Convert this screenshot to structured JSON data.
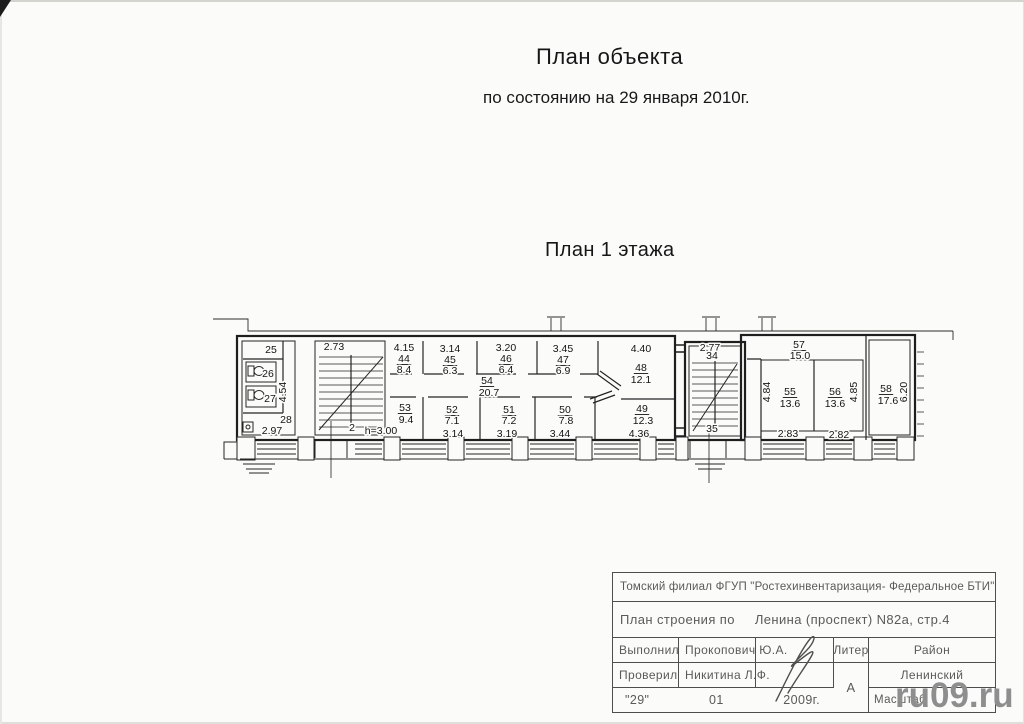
{
  "page": {
    "title": "План объекта",
    "subtitle": "по состоянию на 29 января 2010г.",
    "floor_label": "План 1 этажа",
    "watermark": "ru09.ru"
  },
  "title_block": {
    "org": "Томский филиал ФГУП \"Ростехинвентаризация- Федеральное БТИ\"",
    "doc_type_label": "План строения по",
    "address": "Ленина (проспект) N82а, стр.4",
    "made_label": "Выполнил",
    "made_by": "Прокопович Ю.А.",
    "checked_label": "Проверил",
    "checked_by": "Никитина Л.Ф.",
    "liter_label": "Литер",
    "liter_value": "А",
    "district_label": "Район",
    "district_value": "Ленинский",
    "date_day": "\"29\"",
    "date_month": "01",
    "date_year": "2009г.",
    "scale_label": "Масштаб"
  },
  "plan": {
    "labels": [
      {
        "t": "25",
        "x": 271,
        "y": 353
      },
      {
        "t": "26",
        "x": 268,
        "y": 377
      },
      {
        "t": "27",
        "x": 270,
        "y": 402
      },
      {
        "t": "28",
        "x": 286,
        "y": 423
      },
      {
        "t": "2.97",
        "x": 272,
        "y": 434
      },
      {
        "t": "4.54",
        "x": 286,
        "y": 392,
        "r": -90
      },
      {
        "t": "2.73",
        "x": 334,
        "y": 350
      },
      {
        "t": "2",
        "x": 352,
        "y": 431
      },
      {
        "t": "4.15",
        "x": 404,
        "y": 351
      },
      {
        "t": "44",
        "x": 404,
        "y": 362,
        "ul": 1
      },
      {
        "t": "8.4",
        "x": 404,
        "y": 373
      },
      {
        "t": "3.14",
        "x": 450,
        "y": 352
      },
      {
        "t": "45",
        "x": 450,
        "y": 363,
        "ul": 1
      },
      {
        "t": "6.3",
        "x": 450,
        "y": 374
      },
      {
        "t": "3.20",
        "x": 506,
        "y": 351
      },
      {
        "t": "46",
        "x": 506,
        "y": 362,
        "ul": 1
      },
      {
        "t": "6.4",
        "x": 506,
        "y": 373
      },
      {
        "t": "3.45",
        "x": 563,
        "y": 352
      },
      {
        "t": "47",
        "x": 563,
        "y": 363,
        "ul": 1
      },
      {
        "t": "6.9",
        "x": 563,
        "y": 374
      },
      {
        "t": "4.40",
        "x": 641,
        "y": 352
      },
      {
        "t": "48",
        "x": 641,
        "y": 371,
        "ul": 1
      },
      {
        "t": "12.1",
        "x": 641,
        "y": 383
      },
      {
        "t": "54",
        "x": 487,
        "y": 384,
        "ul": 1
      },
      {
        "t": "20.7",
        "x": 489,
        "y": 396
      },
      {
        "t": "53",
        "x": 405,
        "y": 411,
        "ul": 1
      },
      {
        "t": "9.4",
        "x": 406,
        "y": 423
      },
      {
        "t": "52",
        "x": 452,
        "y": 413,
        "ul": 1
      },
      {
        "t": "7.1",
        "x": 452,
        "y": 424
      },
      {
        "t": "3.14",
        "x": 453,
        "y": 437
      },
      {
        "t": "51",
        "x": 509,
        "y": 413,
        "ul": 1
      },
      {
        "t": "7.2",
        "x": 509,
        "y": 424
      },
      {
        "t": "3.19",
        "x": 507,
        "y": 437
      },
      {
        "t": "50",
        "x": 565,
        "y": 413,
        "ul": 1
      },
      {
        "t": "7.8",
        "x": 566,
        "y": 424
      },
      {
        "t": "3.44",
        "x": 560,
        "y": 437
      },
      {
        "t": "49",
        "x": 642,
        "y": 412,
        "ul": 1
      },
      {
        "t": "12.3",
        "x": 643,
        "y": 424
      },
      {
        "t": "4.36",
        "x": 639,
        "y": 437
      },
      {
        "t": "h=3.00",
        "x": 381,
        "y": 434
      },
      {
        "t": "2.77",
        "x": 710,
        "y": 351
      },
      {
        "t": "34",
        "x": 712,
        "y": 359
      },
      {
        "t": "35",
        "x": 712,
        "y": 432
      },
      {
        "t": "57",
        "x": 799,
        "y": 348,
        "ul": 1
      },
      {
        "t": "15.0",
        "x": 800,
        "y": 359
      },
      {
        "t": "55",
        "x": 790,
        "y": 395,
        "ul": 1
      },
      {
        "t": "13.6",
        "x": 790,
        "y": 407
      },
      {
        "t": "56",
        "x": 835,
        "y": 395,
        "ul": 1
      },
      {
        "t": "13.6",
        "x": 835,
        "y": 407
      },
      {
        "t": "58",
        "x": 886,
        "y": 392,
        "ul": 1
      },
      {
        "t": "17.6",
        "x": 888,
        "y": 404
      },
      {
        "t": "4.84",
        "x": 770,
        "y": 392,
        "r": -90
      },
      {
        "t": "4.85",
        "x": 857,
        "y": 392,
        "r": -90
      },
      {
        "t": "6.20",
        "x": 907,
        "y": 392,
        "r": -90
      },
      {
        "t": "2.83",
        "x": 788,
        "y": 437
      },
      {
        "t": "2.82",
        "x": 839,
        "y": 438
      }
    ]
  }
}
